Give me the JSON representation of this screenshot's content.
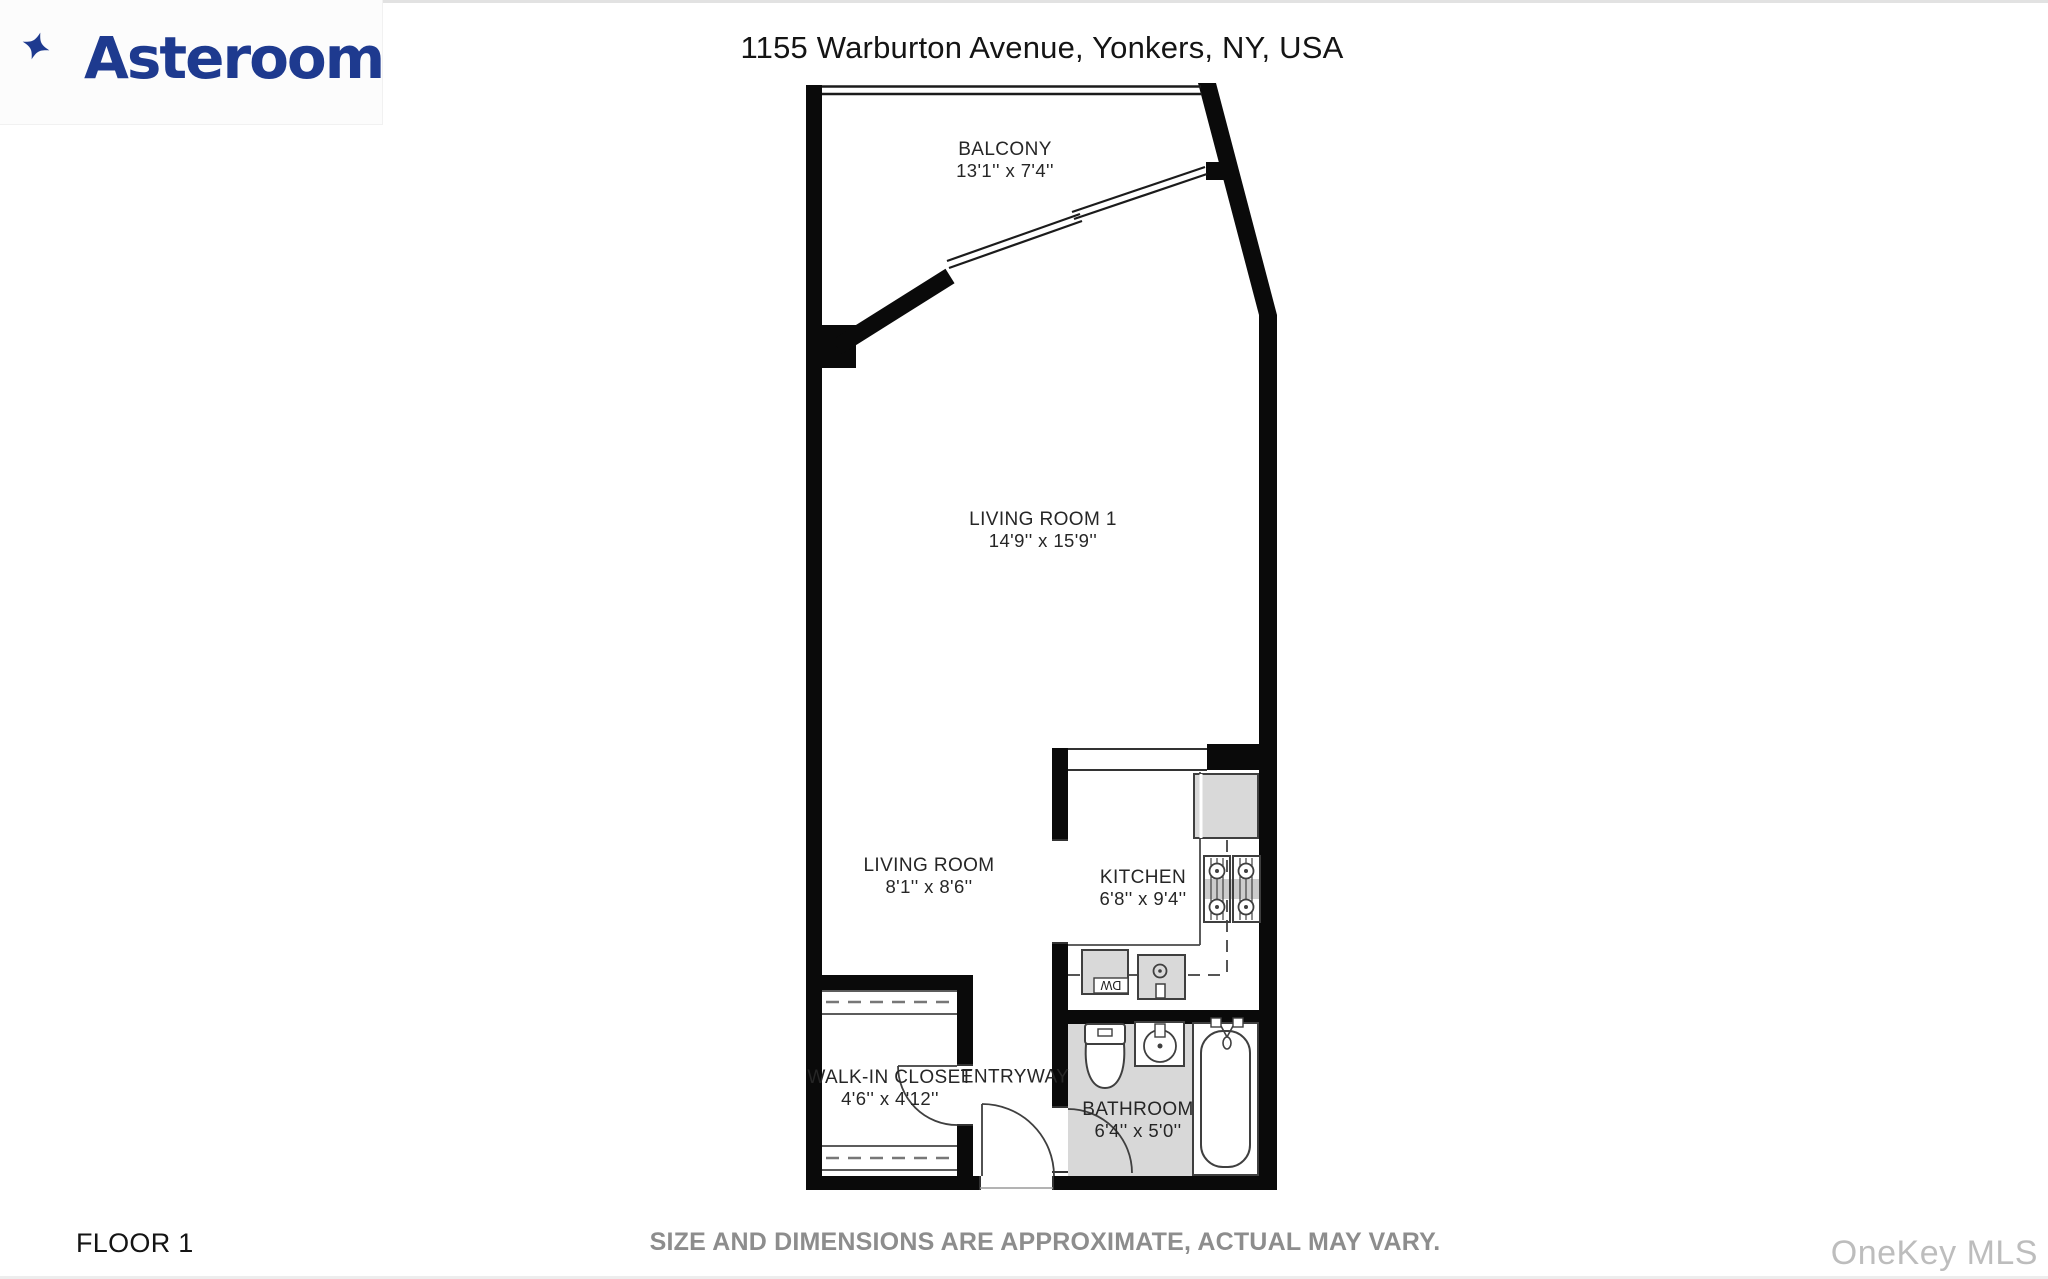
{
  "logo": {
    "brand": "Asteroom",
    "color": "#1e3a8f"
  },
  "header": {
    "address": "1155 Warburton Avenue, Yonkers, NY, USA"
  },
  "floorplan": {
    "rooms": {
      "balcony": {
        "name": "BALCONY",
        "dims": "13'1'' x 7'4''"
      },
      "living_room_1": {
        "name": "LIVING ROOM 1",
        "dims": "14'9'' x 15'9''"
      },
      "living_room": {
        "name": "LIVING ROOM",
        "dims": "8'1'' x 8'6''"
      },
      "kitchen": {
        "name": "KITCHEN",
        "dims": "6'8'' x 9'4''"
      },
      "walk_in_closet": {
        "name": "WALK-IN CLOSET",
        "dims": "4'6'' x 4'12''"
      },
      "entryway": {
        "name": "ENTRYWAY"
      },
      "bathroom": {
        "name": "BATHROOM",
        "dims": "6'4'' x 5'0''"
      }
    },
    "appliances": {
      "dishwasher_label": "DW"
    },
    "colors": {
      "wall": "#0a0a0a",
      "fixture_fill": "#d9d9d9",
      "bathroom_floor": "#d8d8d8"
    }
  },
  "footer": {
    "floor_label": "FLOOR 1",
    "disclaimer": "SIZE AND DIMENSIONS ARE APPROXIMATE, ACTUAL MAY VARY.",
    "watermark": "OneKey MLS"
  }
}
